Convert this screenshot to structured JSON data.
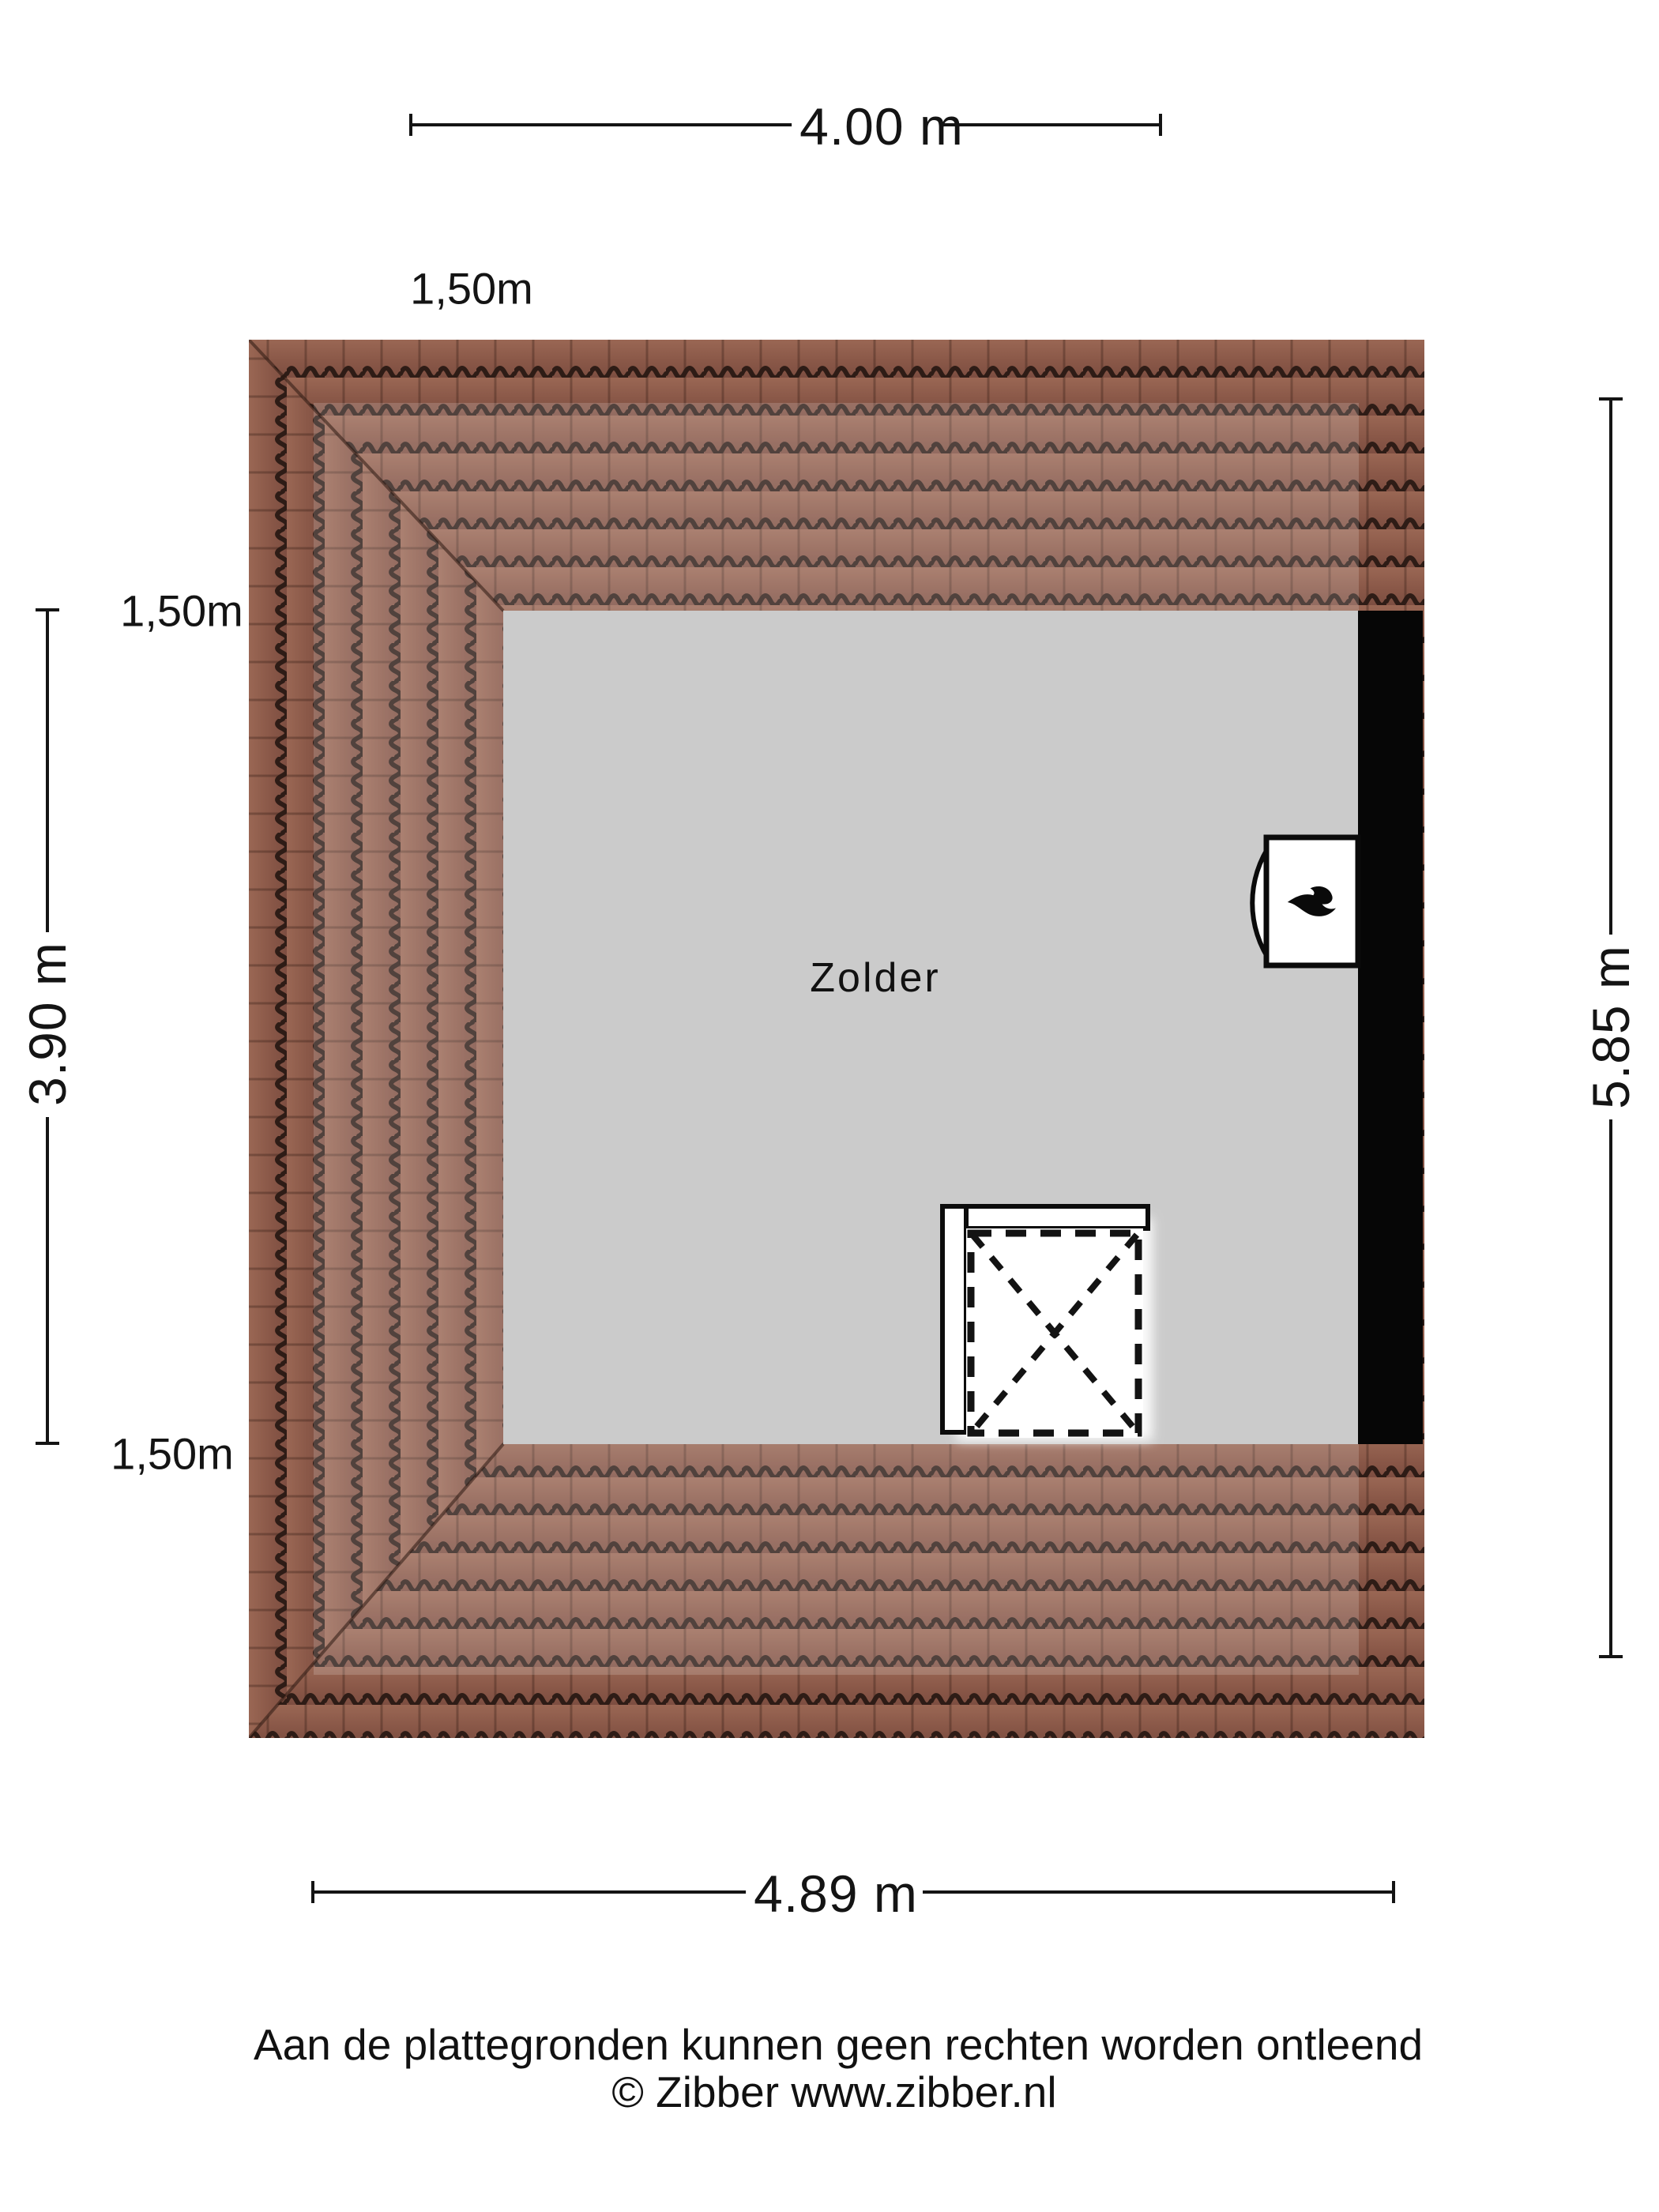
{
  "floorplan": {
    "room": {
      "label": "Zolder"
    },
    "dims": {
      "top": {
        "label": "4.00 m"
      },
      "bottom": {
        "label": "4.89 m"
      },
      "left": {
        "label": "3.90 m"
      },
      "right": {
        "label": "5.85 m"
      },
      "overhang_top": {
        "label": "1,50m"
      },
      "overhang_left_upper": {
        "label": "1,50m"
      },
      "overhang_left_lower": {
        "label": "1,50m"
      }
    },
    "objects": {
      "boiler_icon": "flame-icon",
      "staircase": "open stairwell with dashed cross"
    },
    "colors": {
      "tile": "#8d5b4a",
      "tile_line": "#2e1c16",
      "room": "#cbcbcb",
      "wall": "#060606",
      "ink": "#141414"
    }
  },
  "footer": {
    "disclaimer": "Aan de plattegronden kunnen geen rechten worden ontleend",
    "copyright": "© Zibber www.zibber.nl"
  }
}
